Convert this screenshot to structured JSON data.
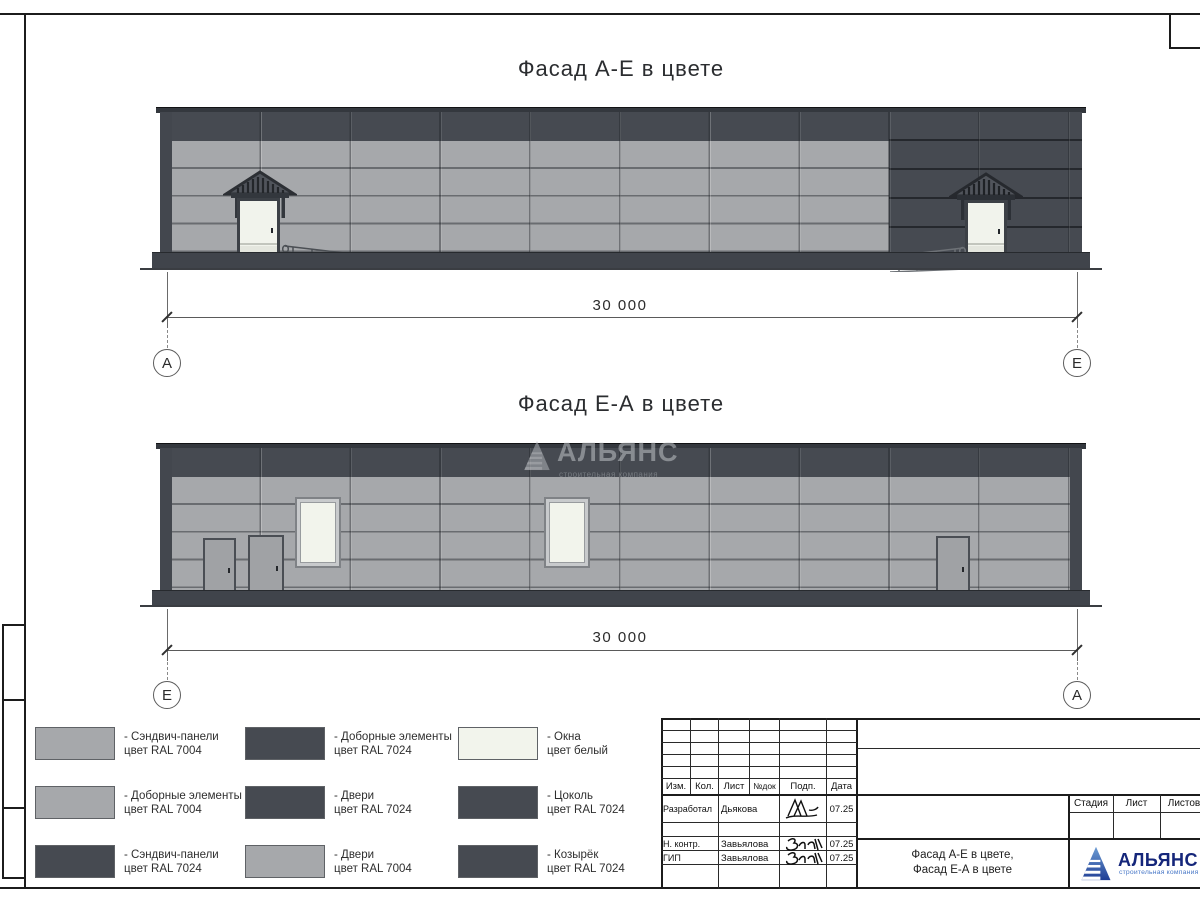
{
  "colors": {
    "panel_light": "#a6a8ab",
    "panel_dark": "#464a51",
    "window_white": "#f2f4ec",
    "base_dark": "#40444b",
    "logo_blue": "#15267a",
    "logo_light_blue": "#4a79c8"
  },
  "views": [
    {
      "title": "Фасад А-Е в цвете",
      "dimension": "30 000",
      "axis_left": "А",
      "axis_right": "Е"
    },
    {
      "title": "Фасад Е-А в цвете",
      "dimension": "30 000",
      "axis_left": "Е",
      "axis_right": "А"
    }
  ],
  "watermark": {
    "title": "АЛЬЯНС",
    "subtitle": "строительная компания"
  },
  "legend": {
    "items": [
      {
        "label": "- Сэндвич-панели",
        "color_note": "цвет RAL 7004",
        "swatch": "#a6a8ab"
      },
      {
        "label": "- Доборные элементы",
        "color_note": "цвет RAL 7024",
        "swatch": "#464a51"
      },
      {
        "label": "- Окна",
        "color_note": "цвет белый",
        "swatch": "#f2f4ec"
      },
      {
        "label": "- Доборные элементы",
        "color_note": "цвет RAL 7004",
        "swatch": "#a6a8ab"
      },
      {
        "label": "- Двери",
        "color_note": "цвет RAL 7024",
        "swatch": "#464a51"
      },
      {
        "label": "- Цоколь",
        "color_note": "цвет RAL 7024",
        "swatch": "#464a51"
      },
      {
        "label": "- Сэндвич-панели",
        "color_note": "цвет RAL 7024",
        "swatch": "#464a51"
      },
      {
        "label": "- Двери",
        "color_note": "цвет RAL 7004",
        "swatch": "#a6a8ab"
      },
      {
        "label": "- Козырёк",
        "color_note": "цвет RAL 7024",
        "swatch": "#464a51"
      }
    ]
  },
  "titleblock": {
    "col_headers": [
      "Изм.",
      "Кол.",
      "Лист",
      "№док",
      "Подп.",
      "Дата"
    ],
    "rows": [
      {
        "role": "Разработал",
        "name": "Дьякова",
        "date": "07.25"
      },
      {
        "role": "Н. контр.",
        "name": "Завьялова",
        "date": "07.25"
      },
      {
        "role": "ГИП",
        "name": "Завьялова",
        "date": "07.25"
      }
    ],
    "stage_headers": [
      "Стадия",
      "Лист",
      "Листов"
    ],
    "doc_title_line1": "Фасад А-Е в цвете,",
    "doc_title_line2": "Фасад Е-А в цвете",
    "logo_title": "АЛЬЯНС",
    "logo_subtitle": "строительная компания"
  }
}
